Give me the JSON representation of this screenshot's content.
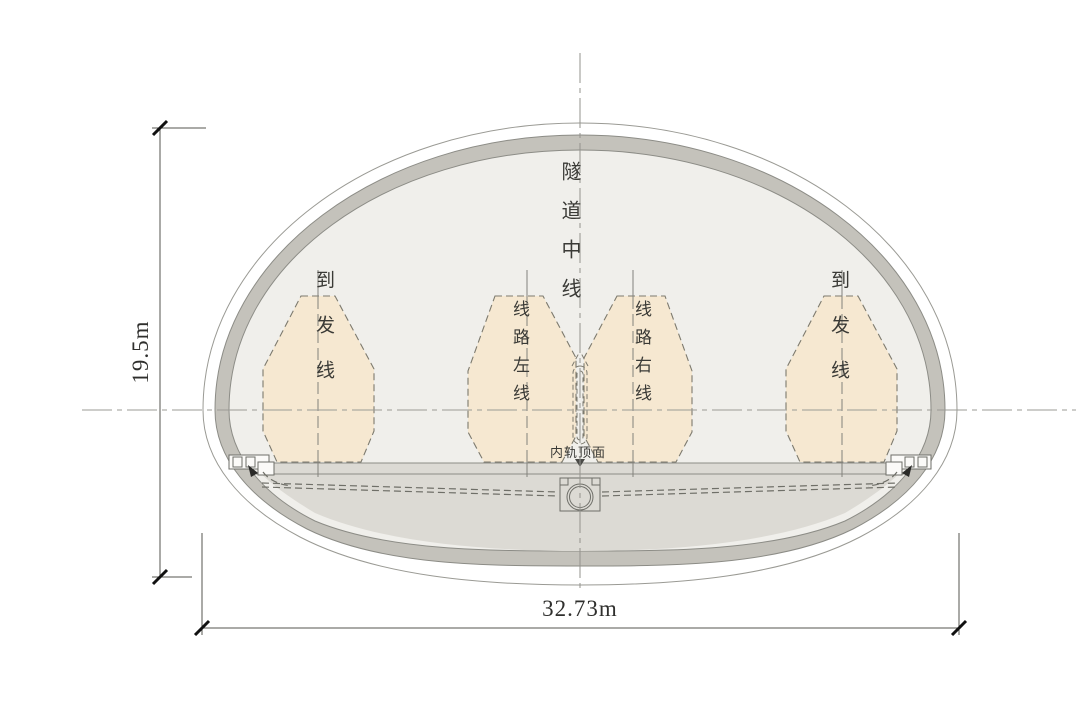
{
  "drawing": {
    "labels": {
      "tunnel_centerline": "隧道中线",
      "siding_left": "到发线",
      "siding_right": "到发线",
      "track_left": "线路左线",
      "track_right": "线路右线",
      "rail_top_surface": "内轨顶面"
    },
    "dimensions": {
      "overall_height": "19.5m",
      "overall_width": "32.73m"
    },
    "colors": {
      "clearance_envelope_fill": "#f6e8d1",
      "clearance_envelope_border": "#7d7a6e",
      "lining_gray": "#c4c2bb",
      "interior_fill": "#f0efeb",
      "invert_fill": "#dcdad4",
      "linework": "#8c8c86",
      "dimension_ink": "#2f2f2d"
    }
  }
}
